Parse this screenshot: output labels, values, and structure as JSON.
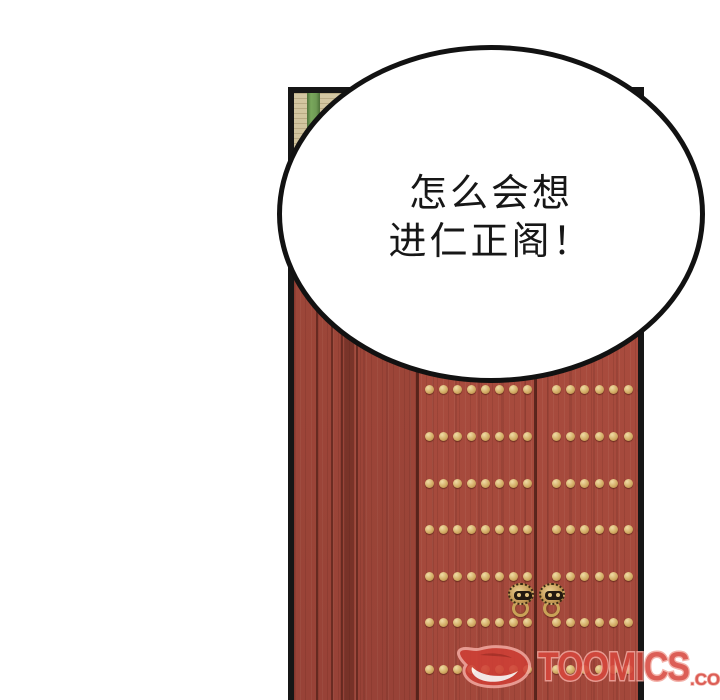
{
  "bubble": {
    "lines": [
      "怎么会想",
      "进仁正阁！"
    ]
  },
  "watermark": {
    "brand": "TOOMICS",
    "suffix": ".COM",
    "logo": "toomics-d-logo",
    "color": "#d7473d",
    "outline_color": "#f2a79e"
  },
  "door": {
    "stud_rows_y": [
      389,
      436,
      483,
      529,
      576,
      622,
      669
    ],
    "stud_groups": [
      {
        "side": "left-leaf",
        "start_x": 429,
        "step_x": 14,
        "count": 8
      },
      {
        "side": "right-leaf",
        "start_x": 556,
        "step_x": 14.4,
        "count": 7
      }
    ],
    "knocker_count": 2
  },
  "colors": {
    "panel_border": "#161616",
    "door_red": "#a94c3e",
    "wall_tan": "#d2c5a0",
    "stripe_green": "#6f9b55",
    "stud_gold": "#d3ad66",
    "bubble_fill": "#ffffff",
    "bubble_stroke": "#121212"
  }
}
